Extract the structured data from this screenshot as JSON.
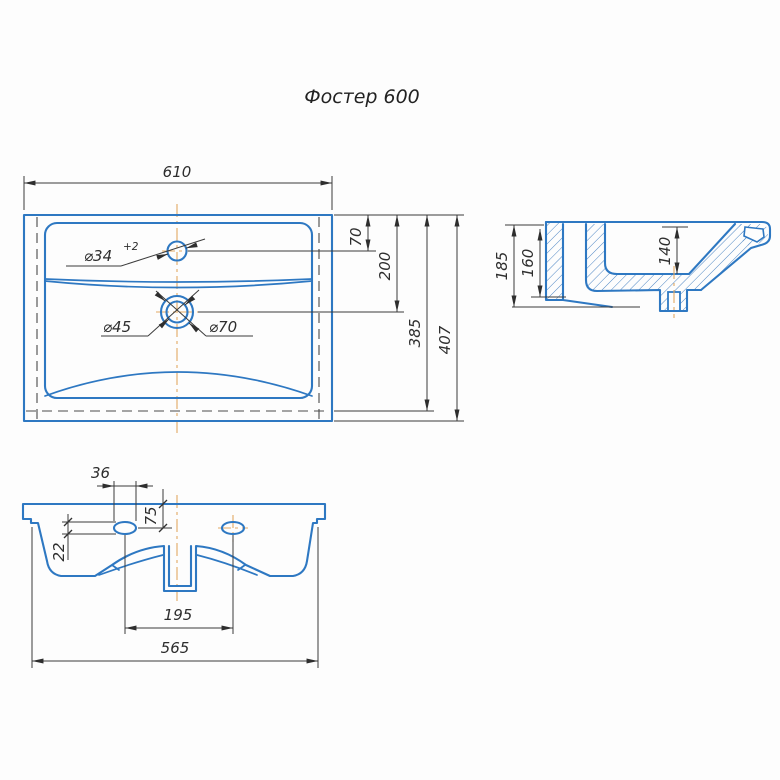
{
  "title": "Фостер 600",
  "colors": {
    "outline_blue": "#2e78c2",
    "dim_line": "#3c3c3c",
    "centerline_orange": "#e2a963",
    "text": "#2e2e2e"
  },
  "top_view": {
    "width": "610",
    "faucet_offset": "70",
    "drain_offset": "200",
    "inner_depth": "385",
    "depth": "407",
    "faucet_dia": "⌀34",
    "faucet_tol": "+2",
    "drain_inner_dia": "⌀45",
    "drain_outer_dia": "⌀70"
  },
  "side_view": {
    "total_height": "185",
    "back_height": "160",
    "bowl_depth": "140"
  },
  "bottom_view": {
    "hole_width": "36",
    "hole_offset": "75",
    "hole_drop": "22",
    "drain_span": "195",
    "base_width": "565"
  }
}
